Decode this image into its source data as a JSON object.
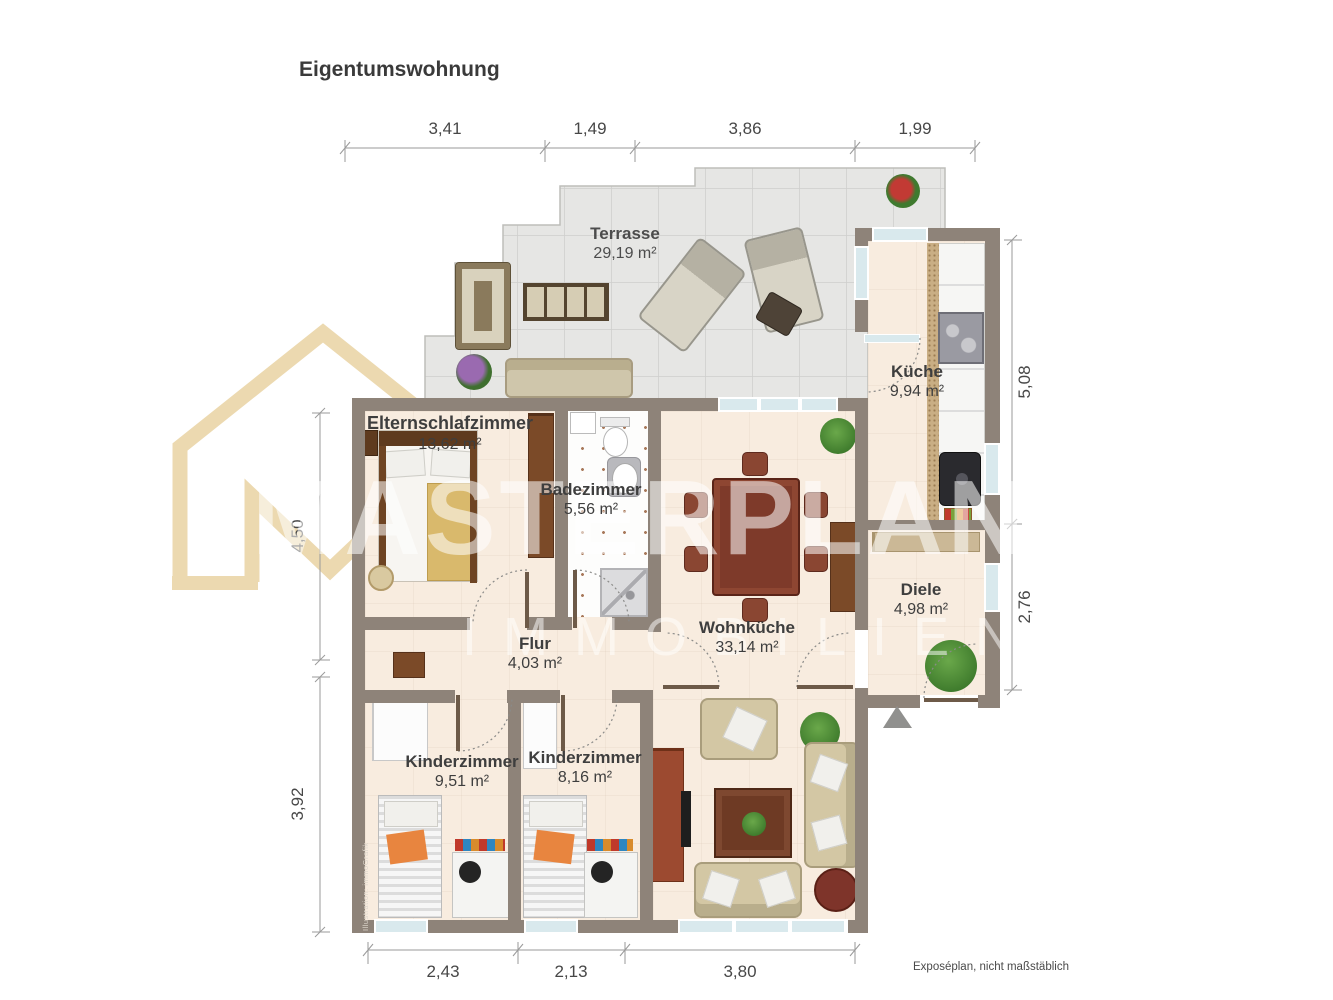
{
  "title": "Eigentumswohnung",
  "watermark": {
    "line1": "MASTERPLAN",
    "line2": "IMMOBILIEN"
  },
  "rooms": [
    {
      "name": "Terrasse",
      "area": "29,19 m²"
    },
    {
      "name": "Küche",
      "area": "9,94 m²"
    },
    {
      "name": "Elternschlafzimmer",
      "area": "13,62 m²"
    },
    {
      "name": "Badezimmer",
      "area": "5,56 m²"
    },
    {
      "name": "Wohnküche",
      "area": "33,14 m²"
    },
    {
      "name": "Diele",
      "area": "4,98 m²"
    },
    {
      "name": "Flur",
      "area": "4,03 m²"
    },
    {
      "name": "Kinderzimmer",
      "area": "9,51 m²"
    },
    {
      "name": "Kinderzimmer",
      "area": "8,16 m²"
    }
  ],
  "dimensions": {
    "top": [
      "3,41",
      "1,49",
      "3,86",
      "1,99"
    ],
    "right": [
      "5,08",
      "2,76"
    ],
    "left": [
      "4,50",
      "3,92"
    ],
    "bottom": [
      "2,43",
      "2,13",
      "3,80"
    ]
  },
  "notes": {
    "scale_note": "Exposéplan, nicht maßstäblich",
    "credit": "Illustration: immoGrafik"
  },
  "colors": {
    "wall": "#8e8379",
    "floor": "#f8ecdf",
    "terrace": "#e6e6e4",
    "watermark": "#ecd9b0",
    "wood": "#7b4a28",
    "accent_orange": "#e8853f",
    "window": "#d9e9ed"
  }
}
